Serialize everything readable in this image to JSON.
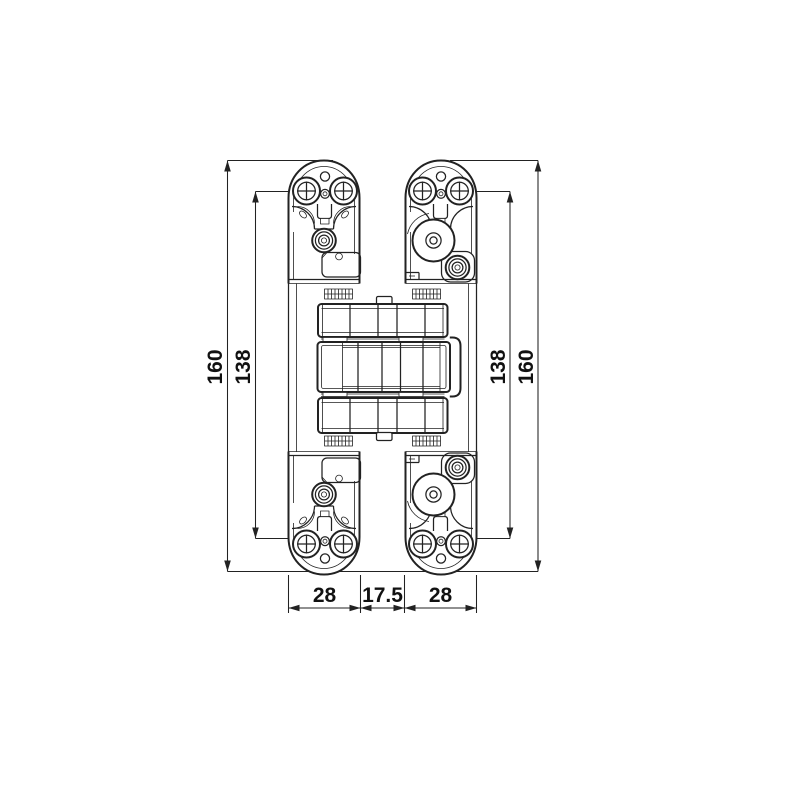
{
  "drawing": {
    "subject": "concealed-hinge-technical-drawing-front-view",
    "background": "#ffffff",
    "line_color": "#222222",
    "text_color": "#111111",
    "dimension_labels": {
      "left_total_height": "160",
      "left_hole_spacing": "138",
      "right_hole_spacing": "138",
      "right_total_height": "160",
      "left_arm_width": "28",
      "center_gap": "17.5",
      "right_arm_width": "28"
    }
  }
}
